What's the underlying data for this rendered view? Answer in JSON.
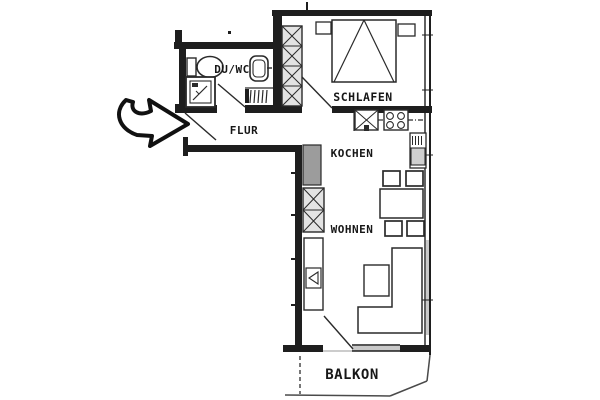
{
  "plan": {
    "type": "apartment-floor-plan",
    "rooms": [
      {
        "key": "duwc",
        "label": "DU/WC"
      },
      {
        "key": "schlafen",
        "label": "SCHLAFEN"
      },
      {
        "key": "flur",
        "label": "FLUR"
      },
      {
        "key": "kochen",
        "label": "KOCHEN"
      },
      {
        "key": "wohnen",
        "label": "WOHNEN"
      },
      {
        "key": "balkon",
        "label": "BALKON"
      }
    ],
    "fixtures": [
      "entrance-arrow",
      "entrance-door-swing",
      "toilet",
      "washbasin",
      "shower",
      "radiator",
      "wardrobe",
      "double-bed",
      "nightstand-left",
      "nightstand-right",
      "bedroom-door-swing",
      "kitchen-sink",
      "stove",
      "tall-kitchen-unit",
      "kitchen-counter",
      "dining-table",
      "dining-chairs",
      "shelf-unit",
      "sideboard",
      "tv",
      "sofa-l-shaped",
      "coffee-table",
      "balcony-door-swing",
      "window-band",
      "balcony-outline"
    ],
    "colors": {
      "background": "#ffffff",
      "wall": "#1e1e1e",
      "line": "#2a2a2a",
      "furniture_fill": "#e3e3e3",
      "counter_gray": "#9c9c9c",
      "window_gray": "#c9c9c9"
    }
  }
}
